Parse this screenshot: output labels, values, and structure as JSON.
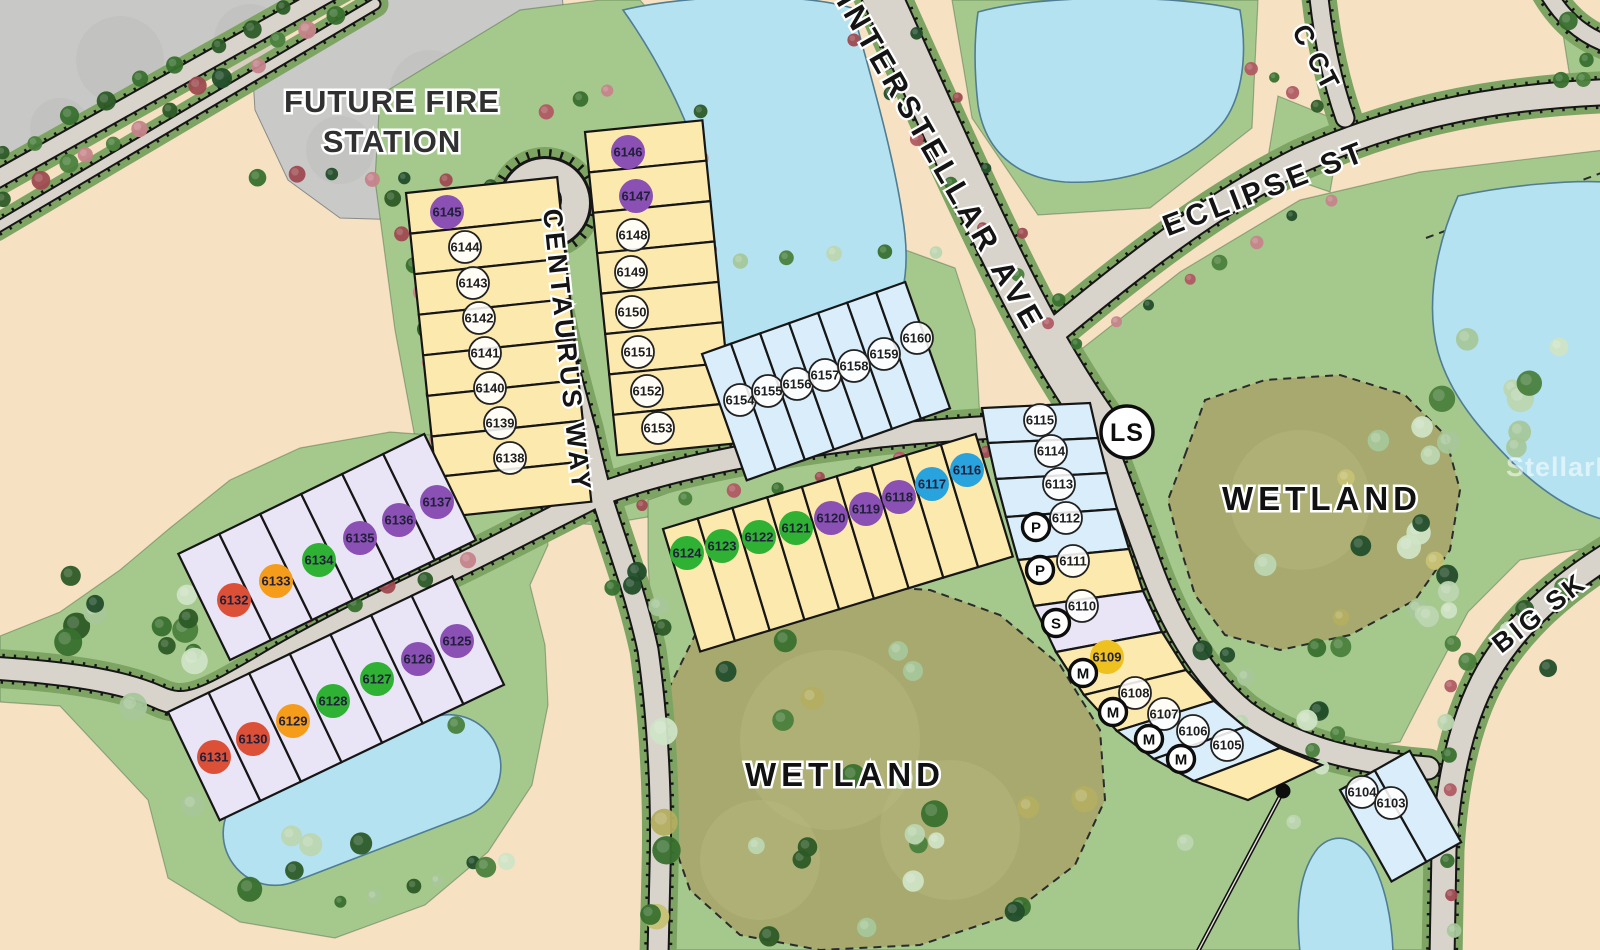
{
  "map": {
    "area_labels": {
      "fire_station_line1": "FUTURE FIRE",
      "fire_station_line2": "STATION",
      "wetland_center": "WETLAND",
      "wetland_right": "WETLAND",
      "lift_station_badge": "LS",
      "watermark": "StellarMLS"
    },
    "street_labels": [
      "CENTAURUS WAY",
      "INTERSTELLAR AVE",
      "ECLIPSE ST",
      "C CT",
      "BIG SK"
    ],
    "lot_fill_colors": {
      "yellow": "#fce9ad",
      "blue": "#d9eefa",
      "lavender": "#e9e4f6"
    },
    "marker_colors": {
      "purple": "#8b50b4",
      "green": "#2fb133",
      "orange": "#f59c1a",
      "red": "#dd5038",
      "cyan": "#29a3dd",
      "gold": "#efc11f"
    },
    "rows": {
      "culdesac_west": {
        "fill": "yellow",
        "lots": [
          {
            "id": "6145",
            "marker": "purple"
          },
          {
            "id": "6144",
            "marker": "open"
          },
          {
            "id": "6143",
            "marker": "open"
          },
          {
            "id": "6142",
            "marker": "open"
          },
          {
            "id": "6141",
            "marker": "open"
          },
          {
            "id": "6140",
            "marker": "open"
          },
          {
            "id": "6139",
            "marker": "open"
          },
          {
            "id": "6138",
            "marker": "open"
          }
        ]
      },
      "culdesac_east": {
        "fill": "yellow",
        "lots": [
          {
            "id": "6146",
            "marker": "purple"
          },
          {
            "id": "6147",
            "marker": "purple"
          },
          {
            "id": "6148",
            "marker": "open"
          },
          {
            "id": "6149",
            "marker": "open"
          },
          {
            "id": "6150",
            "marker": "open"
          },
          {
            "id": "6151",
            "marker": "open"
          },
          {
            "id": "6152",
            "marker": "open"
          },
          {
            "id": "6153",
            "marker": "open"
          }
        ]
      },
      "lake_row": {
        "fill": "blue",
        "lots": [
          {
            "id": "6154",
            "marker": "open"
          },
          {
            "id": "6155",
            "marker": "open"
          },
          {
            "id": "6156",
            "marker": "open"
          },
          {
            "id": "6157",
            "marker": "open"
          },
          {
            "id": "6158",
            "marker": "open"
          },
          {
            "id": "6159",
            "marker": "open"
          },
          {
            "id": "6160",
            "marker": "open"
          }
        ]
      },
      "mid_row": {
        "fill": "yellow",
        "lots": [
          {
            "id": "6124",
            "marker": "green"
          },
          {
            "id": "6123",
            "marker": "green"
          },
          {
            "id": "6122",
            "marker": "green"
          },
          {
            "id": "6121",
            "marker": "green"
          },
          {
            "id": "6120",
            "marker": "purple"
          },
          {
            "id": "6119",
            "marker": "purple"
          },
          {
            "id": "6118",
            "marker": "purple"
          },
          {
            "id": "6117",
            "marker": "cyan"
          },
          {
            "id": "6116",
            "marker": "cyan"
          }
        ]
      },
      "east_arc": {
        "fill": "mixed",
        "lots": [
          {
            "id": "6115",
            "marker": "open",
            "fill": "blue"
          },
          {
            "id": "6114",
            "marker": "open",
            "fill": "blue"
          },
          {
            "id": "6113",
            "marker": "open",
            "fill": "blue"
          },
          {
            "id": "6112",
            "marker": "open",
            "fill": "blue",
            "badge": "P"
          },
          {
            "id": "6111",
            "marker": "open",
            "fill": "yellow",
            "badge": "P"
          },
          {
            "id": "6110",
            "marker": "open",
            "fill": "lavender",
            "badge": "S"
          },
          {
            "id": "6109",
            "marker": "gold",
            "fill": "yellow",
            "badge": "M"
          },
          {
            "id": "6108",
            "marker": "open",
            "fill": "yellow",
            "badge": "M"
          },
          {
            "id": "6107",
            "marker": "open",
            "fill": "blue",
            "badge": "M"
          },
          {
            "id": "6106",
            "marker": "open",
            "fill": "blue",
            "badge": "M"
          },
          {
            "id": "6105",
            "marker": "open",
            "fill": "yellow"
          }
        ]
      },
      "upper_purple": {
        "fill": "lavender",
        "lots": [
          {
            "id": "6132",
            "marker": "red"
          },
          {
            "id": "6133",
            "marker": "orange"
          },
          {
            "id": "6134",
            "marker": "green"
          },
          {
            "id": "6135",
            "marker": "purple"
          },
          {
            "id": "6136",
            "marker": "purple"
          },
          {
            "id": "6137",
            "marker": "purple"
          }
        ]
      },
      "lower_purple": {
        "fill": "lavender",
        "lots": [
          {
            "id": "6131",
            "marker": "red"
          },
          {
            "id": "6130",
            "marker": "red"
          },
          {
            "id": "6129",
            "marker": "orange"
          },
          {
            "id": "6128",
            "marker": "green"
          },
          {
            "id": "6127",
            "marker": "green"
          },
          {
            "id": "6126",
            "marker": "purple"
          },
          {
            "id": "6125",
            "marker": "purple"
          }
        ]
      },
      "south_pair": {
        "fill": "blue",
        "lots": [
          {
            "id": "6104",
            "marker": "open"
          },
          {
            "id": "6103",
            "marker": "open"
          }
        ]
      }
    }
  }
}
